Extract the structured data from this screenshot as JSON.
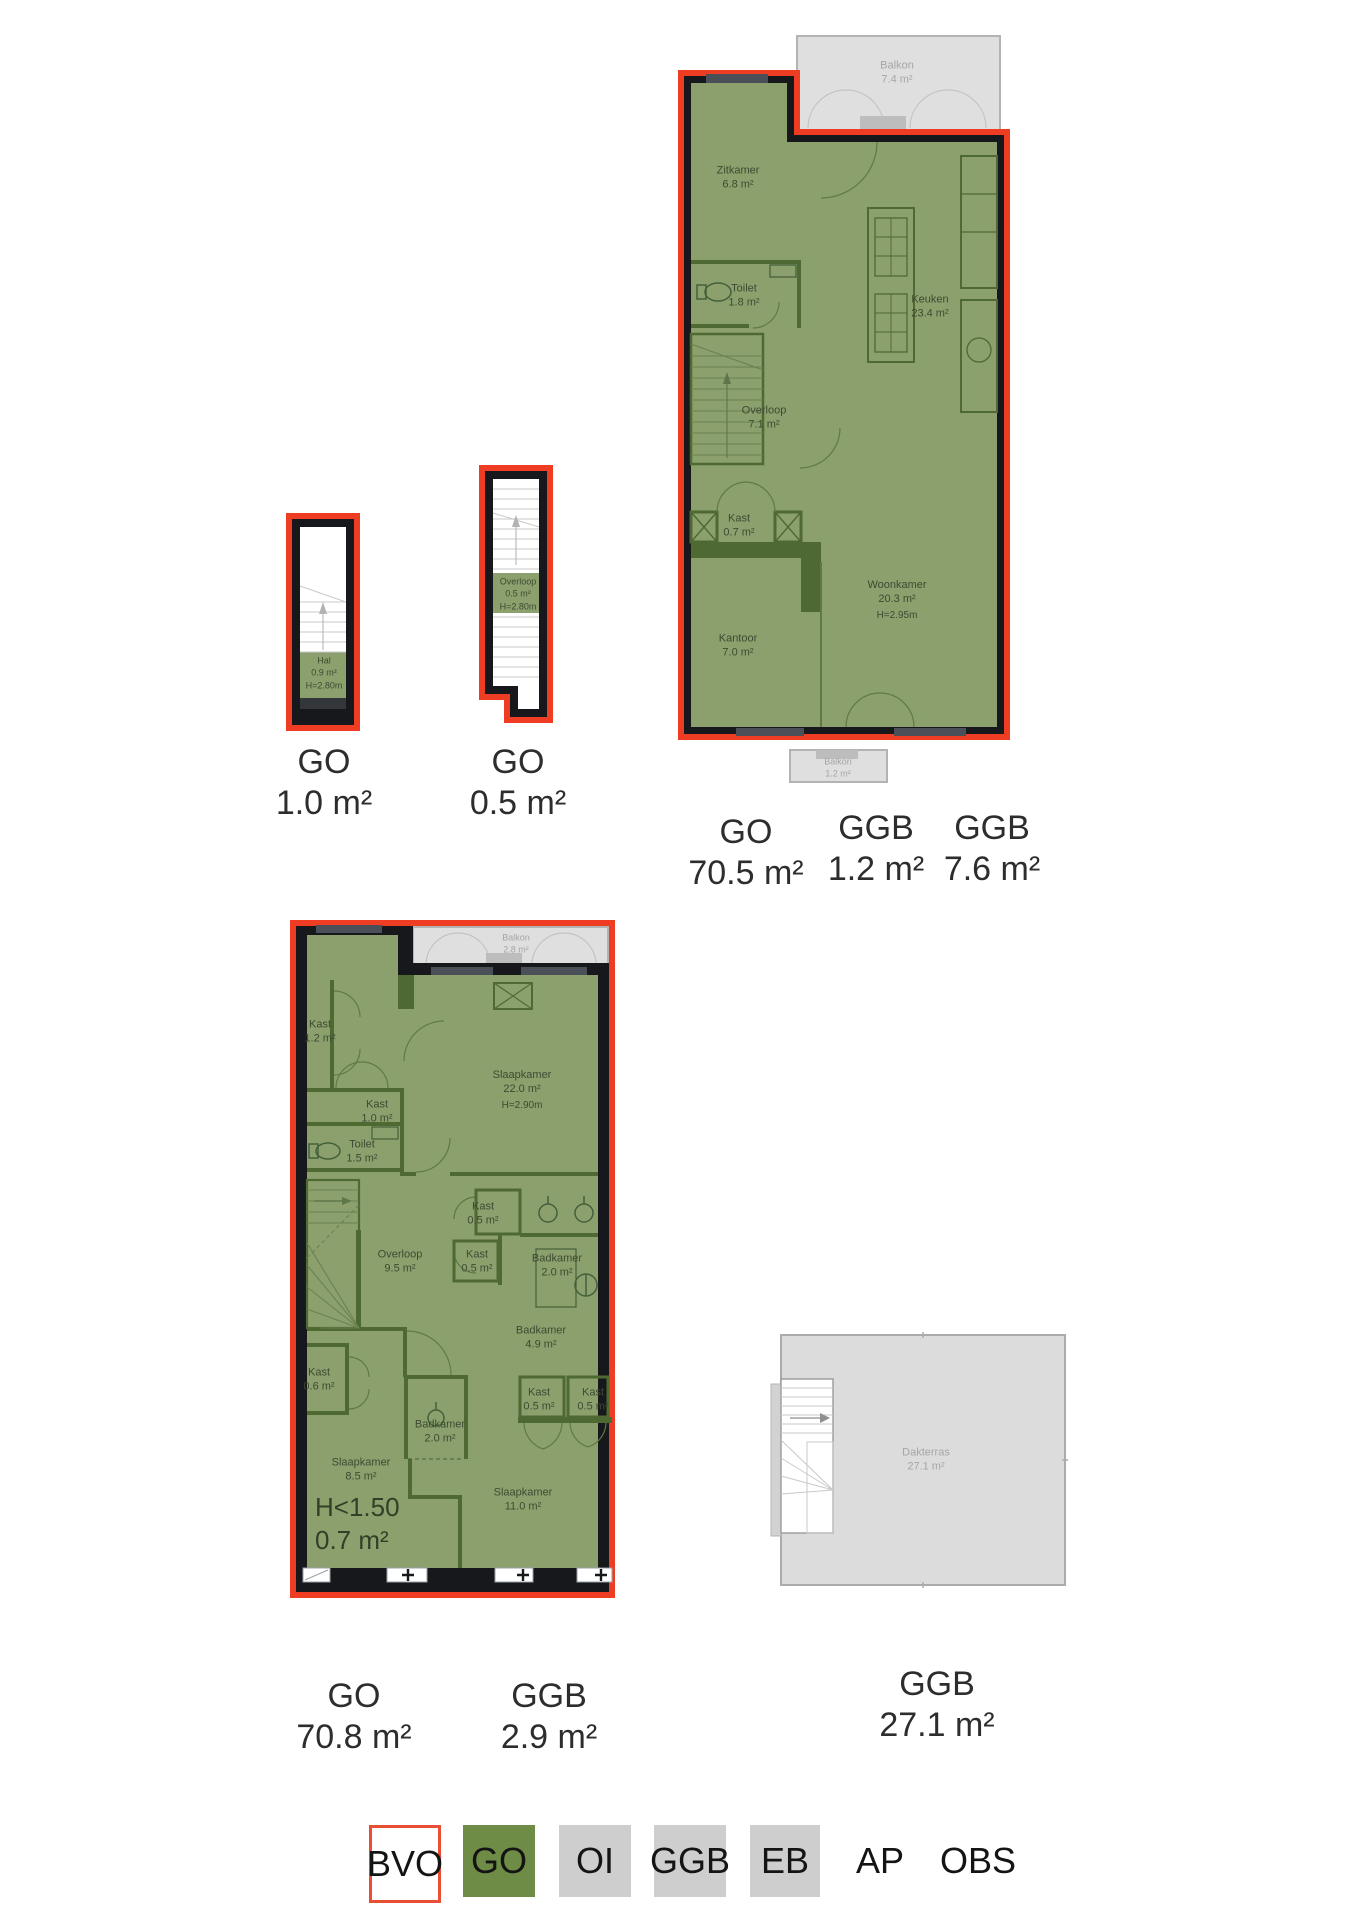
{
  "colors": {
    "bvo_red": "#ee3d22",
    "go_green": "#6e8c46",
    "plan_fill_green": "#8ca06e",
    "wall_dark_green": "#4e6931",
    "wall_black": "#16181b",
    "ggb_grey": "#dedede",
    "legend_grey": "#cecece"
  },
  "plans": {
    "hal": {
      "rooms": {
        "hal": {
          "name": "Hal",
          "area": "0.9 m²",
          "height": "H=2.80m"
        }
      },
      "area_labels": [
        {
          "type": "GO",
          "value": "1.0 m²"
        }
      ]
    },
    "stair": {
      "rooms": {
        "overloop": {
          "name": "Overloop",
          "area": "0.5 m²",
          "height": "H=2.80m"
        }
      },
      "area_labels": [
        {
          "type": "GO",
          "value": "0.5 m²"
        }
      ]
    },
    "floor1": {
      "rooms": {
        "balkon_top": {
          "name": "Balkon",
          "area": "7.4 m²"
        },
        "zitkamer": {
          "name": "Zitkamer",
          "area": "6.8 m²"
        },
        "toilet": {
          "name": "Toilet",
          "area": "1.8 m²"
        },
        "keuken": {
          "name": "Keuken",
          "area": "23.4 m²"
        },
        "overloop": {
          "name": "Overloop",
          "area": "7.1 m²"
        },
        "kast": {
          "name": "Kast",
          "area": "0.7 m²"
        },
        "kantoor": {
          "name": "Kantoor",
          "area": "7.0 m²"
        },
        "woonkamer": {
          "name": "Woonkamer",
          "area": "20.3 m²",
          "height": "H=2.95m"
        },
        "balkon_bottom": {
          "name": "Balkon",
          "area": "1.2 m²"
        }
      },
      "area_labels": [
        {
          "type": "GO",
          "value": "70.5 m²"
        },
        {
          "type": "GGB",
          "value": "1.2 m²"
        },
        {
          "type": "GGB",
          "value": "7.6 m²"
        }
      ]
    },
    "floor2": {
      "rooms": {
        "balkon": {
          "name": "Balkon",
          "area": "2.8 m²"
        },
        "kast12": {
          "name": "Kast",
          "area": "1.2 m²"
        },
        "slaapkamer22": {
          "name": "Slaapkamer",
          "area": "22.0 m²",
          "height": "H=2.90m"
        },
        "kast10": {
          "name": "Kast",
          "area": "1.0 m²"
        },
        "toilet15": {
          "name": "Toilet",
          "area": "1.5 m²"
        },
        "kast05a": {
          "name": "Kast",
          "area": "0.5 m²"
        },
        "overloop95": {
          "name": "Overloop",
          "area": "9.5 m²"
        },
        "kast05b": {
          "name": "Kast",
          "area": "0.5 m²"
        },
        "badkamer20a": {
          "name": "Badkamer",
          "area": "2.0 m²"
        },
        "badkamer49": {
          "name": "Badkamer",
          "area": "4.9 m²"
        },
        "kast06": {
          "name": "Kast",
          "area": "0.6 m²"
        },
        "kast05c": {
          "name": "Kast",
          "area": "0.5 m²"
        },
        "kast05d": {
          "name": "Kast",
          "area": "0.5 m²"
        },
        "badkamer20b": {
          "name": "Badkamer",
          "area": "2.0 m²"
        },
        "slaapkamer85": {
          "name": "Slaapkamer",
          "area": "8.5 m²"
        },
        "slaapkamer11": {
          "name": "Slaapkamer",
          "area": "11.0 m²"
        },
        "lowheight": {
          "name": "H<1.50",
          "area": "0.7 m²"
        }
      },
      "area_labels": [
        {
          "type": "GO",
          "value": "70.8 m²"
        },
        {
          "type": "GGB",
          "value": "2.9 m²"
        }
      ]
    },
    "roof": {
      "rooms": {
        "dakterras": {
          "name": "Dakterras",
          "area": "27.1 m²"
        }
      },
      "area_labels": [
        {
          "type": "GGB",
          "value": "27.1 m²"
        }
      ]
    }
  },
  "legend": {
    "items": [
      {
        "label": "BVO",
        "swatch": "bvo"
      },
      {
        "label": "GO",
        "swatch": "go"
      },
      {
        "label": "OI",
        "swatch": "grey"
      },
      {
        "label": "GGB",
        "swatch": "grey"
      },
      {
        "label": "EB",
        "swatch": "grey"
      },
      {
        "label": "AP",
        "swatch": "none"
      },
      {
        "label": "OBS",
        "swatch": "none"
      }
    ]
  }
}
